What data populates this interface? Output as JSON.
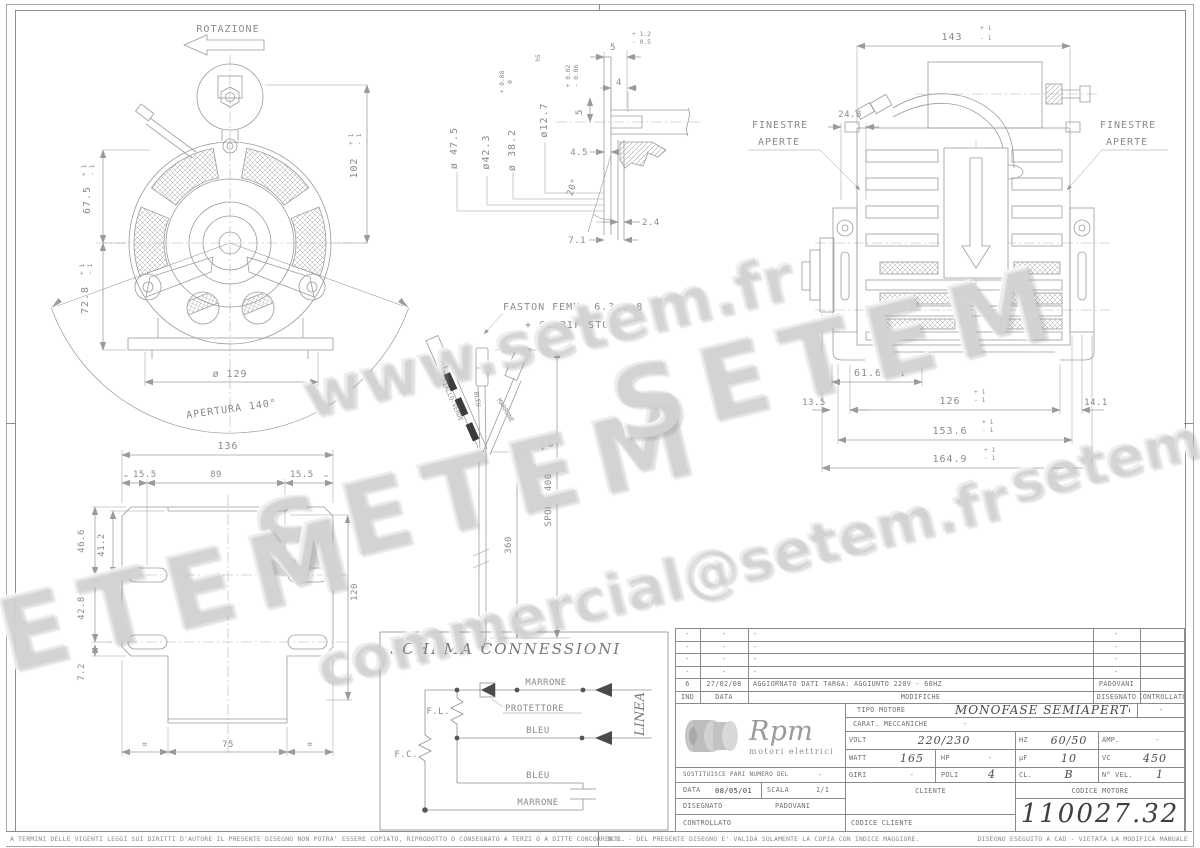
{
  "watermarks": {
    "w1": "www.setem.fr",
    "w2": "SETEM",
    "w3": "SETEM",
    "w4": "commercial@setem.fr",
    "w5": "setem.fr",
    "w6": "SETEM"
  },
  "front": {
    "rotazione": "ROTAZIONE",
    "dim_675": {
      "v": "67.5",
      "p": "+ 1",
      "m": "- 1"
    },
    "dim_102": {
      "v": "102",
      "p": "+ 1",
      "m": "- 1"
    },
    "dim_728": {
      "v": "72.8",
      "p": "+ 1",
      "m": "- 1"
    },
    "dia_129": "ø 129",
    "apertura": "APERTURA 140°"
  },
  "shaft": {
    "dia_475": "ø 47.5",
    "dia_423": "ø42.3",
    "dia_382": {
      "v": "ø 38.2",
      "p": "+ 0.08",
      "m": "0"
    },
    "dia_127": {
      "v": "ø12.7",
      "suffix": "h5"
    },
    "key_w": "4",
    "key_d": {
      "v": "5",
      "p": "+ 0.02",
      "m": "- 0.06"
    },
    "len_5": {
      "v": "5",
      "p": "+ 1.2",
      "m": "- 0.5"
    },
    "len_45": "4.5",
    "ang_20": "20°",
    "len_24": "2.4",
    "len_71": "7.1"
  },
  "side": {
    "dim_143": {
      "v": "143",
      "p": "+ 1",
      "m": "- 1"
    },
    "dim_248": "24.8",
    "fin_l1": "FINESTRE",
    "fin_l2": "APERTE",
    "fin_r1": "FINESTRE",
    "fin_r2": "APERTE",
    "dim_616": {
      "v": "61.6",
      "p": "+ 1",
      "m": "- 1"
    },
    "dim_135": "13.5",
    "dim_126": {
      "v": "126",
      "p": "+ 1",
      "m": "- 1"
    },
    "dim_141": "14.1",
    "dim_1536": {
      "v": "153.6",
      "p": "+ 1",
      "m": "- 1"
    },
    "dim_1649": {
      "v": "164.9",
      "p": "+ 1",
      "m": "- 1"
    }
  },
  "plate": {
    "dim_136": "136",
    "dim_155l": "15.5",
    "dim_89": "89",
    "dim_155r": "15.5",
    "dim_466": "46.6",
    "dim_412": "41.2",
    "dim_428": "42.8",
    "dim_72": "7.2",
    "dim_75": "75",
    "dim_120": "120",
    "eq_tl": "=",
    "eq_tr": "=",
    "eq_bl": "=",
    "eq_br": "="
  },
  "faston": {
    "line1": "FASTON FEMM. 6.3x0.8",
    "line2": "+ COPRIFASTON",
    "wire_gv": "GIALLO-VERDE",
    "wire_bleu": "BLEU",
    "wire_marrone": "MARRONE",
    "dim_360": "360",
    "sporg": {
      "v": "SPORG.400",
      "p": "+50",
      "m": "0"
    }
  },
  "schema": {
    "title": "SCHEMA CONNESSIONI",
    "fl": "F.L.",
    "fc": "F.C.",
    "protettore": "PROTETTORE",
    "marrone_top": "MARRONE",
    "bleu_mid": "BLEU",
    "bleu_low": "BLEU",
    "marrone_low": "MARRONE",
    "linea": "LINEA"
  },
  "titleblock": {
    "revisions": [
      {
        "ind": "-",
        "date": "-",
        "mod": "-",
        "dis": "-",
        "contr": ""
      },
      {
        "ind": "-",
        "date": "-",
        "mod": "-",
        "dis": "-",
        "contr": ""
      },
      {
        "ind": "-",
        "date": "-",
        "mod": "-",
        "dis": "-",
        "contr": ""
      },
      {
        "ind": "-",
        "date": "-",
        "mod": "-",
        "dis": "-",
        "contr": ""
      },
      {
        "ind": "6",
        "date": "27/02/08",
        "mod": "AGGIORNATO DATI TARGA: AGGIUNTO 220V - 60HZ",
        "dis": "PADOVANI",
        "contr": ""
      }
    ],
    "headers": {
      "ind": "IND",
      "data": "DATA",
      "modifiche": "MODIFICHE",
      "disegnato": "DISEGNATO",
      "controllato": "CONTROLLATO"
    },
    "logo": {
      "name": "Rpm",
      "sub": "motori elettrici"
    },
    "tipo": {
      "label": "TIPO MOTORE",
      "value": "MONOFASE SEMIAPERTO",
      "extra": "-"
    },
    "carat": {
      "label": "CARAT. MECCANICHE",
      "value": "-"
    },
    "volt": {
      "label": "VOLT",
      "value": "220/230"
    },
    "hz": {
      "label": "HZ",
      "value": "60/50"
    },
    "amp": {
      "label": "AMP.",
      "value": "-"
    },
    "watt": {
      "label": "WATT",
      "value": "165"
    },
    "hp": {
      "label": "HP",
      "value": "-"
    },
    "uf": {
      "label": "µF",
      "value": "10"
    },
    "vc": {
      "label": "VC",
      "value": "450"
    },
    "giri": {
      "label": "GIRI",
      "value": "-"
    },
    "poli": {
      "label": "POLI",
      "value": "4"
    },
    "cl": {
      "label": "CL.",
      "value": "B"
    },
    "nvel": {
      "label": "N° VEL.",
      "value": "1"
    },
    "sostituisce": {
      "label": "SOSTITUISCE PARI NUMERO DEL",
      "value": "-"
    },
    "data": {
      "label": "DATA",
      "value": "08/05/01"
    },
    "scala": {
      "label": "SCALA",
      "value": "1/1"
    },
    "disegnato": {
      "label": "DISEGNATO",
      "value": "PADOVANI"
    },
    "controllato": {
      "label": "CONTROLLATO",
      "value": ""
    },
    "cliente": "CLIENTE",
    "codice_motore": "CODICE MOTORE",
    "codice": "110027.32",
    "codice_cliente": "CODICE CLIENTE"
  },
  "footer": {
    "left": "A TERMINI DELLE VIGENTI LEGGI SUI DIRITTI D'AUTORE IL PRESENTE DISEGNO NON POTRA' ESSERE COPIATO, RIPRODOTTO O CONSEGNATO A TERZI O A DITTE CONCORRENTI.",
    "nb": "N.B. - DEL PRESENTE DISEGNO E' VALIDA SOLAMENTE LA COPIA CON INDICE MAGGIORE.",
    "cad": "DISEGNO ESEGUITO A CAD - VIETATA LA MODIFICA MANUALE"
  },
  "colors": {
    "line": "#9b9b9b",
    "text": "#8a8a8a",
    "accent_dark": "#3f3f3f"
  }
}
